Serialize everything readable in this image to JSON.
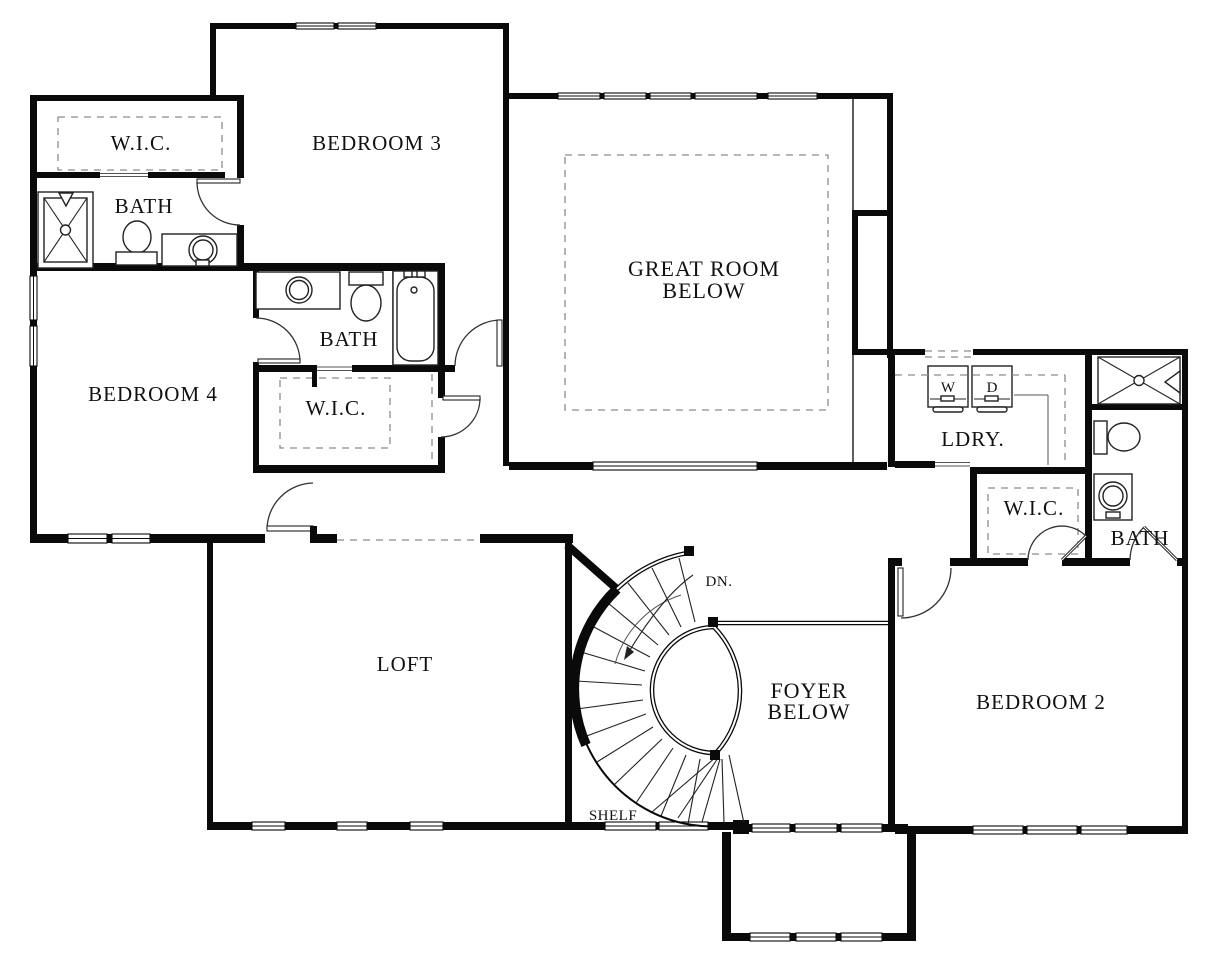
{
  "document": {
    "type": "floor-plan",
    "floor": "second-floor"
  },
  "colors": {
    "walls": "#0a0a0a",
    "paper": "#ffffff",
    "dashed_openings": "#8c8c8c",
    "fixtures": "#222222"
  },
  "labels": {
    "wic_top_left": "W.I.C.",
    "bath_top_left": "BATH",
    "bedroom3": "BEDROOM 3",
    "great_room_line1": "GREAT ROOM",
    "great_room_line2": "BELOW",
    "bath_middle": "BATH",
    "wic_middle": "W.I.C.",
    "bedroom4": "BEDROOM 4",
    "washer": "W",
    "dryer": "D",
    "laundry": "LDRY.",
    "wic_right": "W.I.C.",
    "bath_right": "BATH",
    "loft": "LOFT",
    "stairs_direction": "DN.",
    "shelf": "SHELF",
    "foyer_line1": "FOYER",
    "foyer_line2": "BELOW",
    "bedroom2": "BEDROOM 2"
  }
}
